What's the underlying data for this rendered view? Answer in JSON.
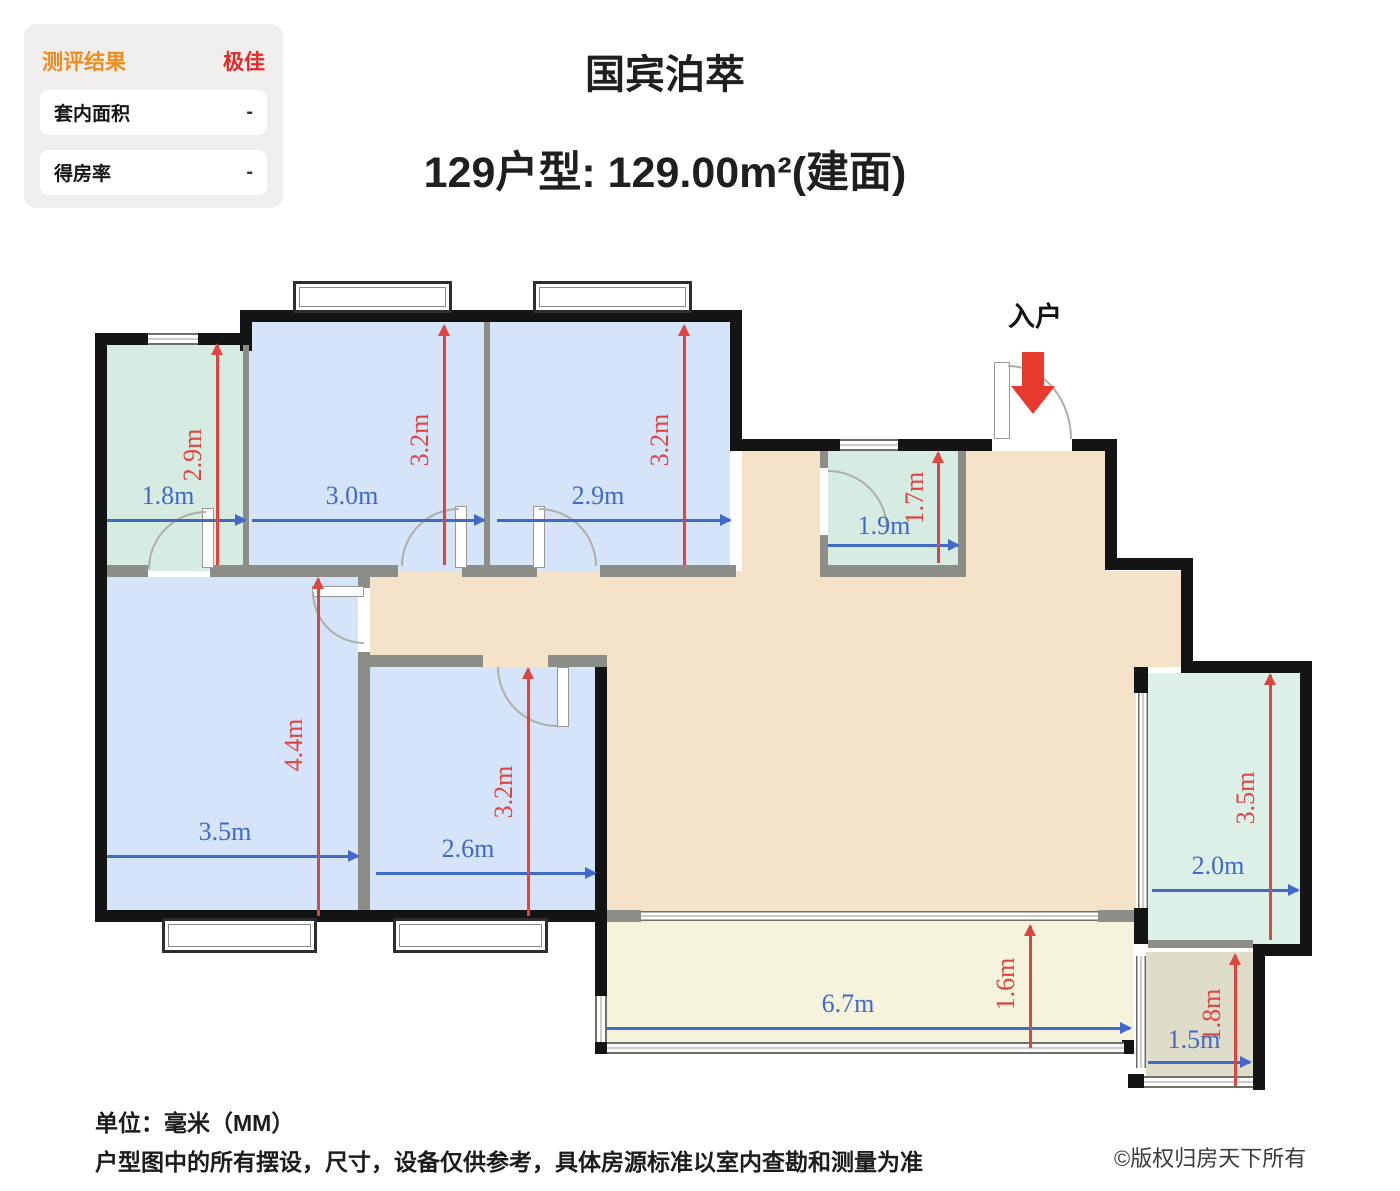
{
  "panel": {
    "title": "测评结果",
    "rating": "极佳",
    "rows": [
      {
        "label": "套内面积",
        "value": "-"
      },
      {
        "label": "得房率",
        "value": "-"
      }
    ]
  },
  "header": {
    "title": "国宾泊萃",
    "subtitle": "129户型: 129.00m²(建面)"
  },
  "plan": {
    "entrance_label": "入户",
    "rooms": [
      {
        "id": "bath-top-left",
        "type": "bathroom",
        "width": "1.8m",
        "height": "2.9m"
      },
      {
        "id": "bedroom-top-1",
        "type": "bedroom",
        "width": "3.0m",
        "height": "3.2m"
      },
      {
        "id": "bedroom-top-2",
        "type": "bedroom",
        "width": "2.9m",
        "height": "3.2m"
      },
      {
        "id": "bathroom-entry",
        "type": "bathroom",
        "width": "1.9m",
        "height": "1.7m"
      },
      {
        "id": "bedroom-master",
        "type": "bedroom",
        "width": "3.5m",
        "height": "4.4m"
      },
      {
        "id": "bedroom-3",
        "type": "bedroom",
        "width": "2.6m",
        "height": "3.2m"
      },
      {
        "id": "room-right",
        "type": "room",
        "width": "2.0m",
        "height": "3.5m"
      },
      {
        "id": "balcony",
        "type": "balcony",
        "width": "6.7m",
        "height": "1.6m"
      },
      {
        "id": "storage-bottom-right",
        "type": "room",
        "width": "1.5m",
        "height": "1.8m"
      }
    ]
  },
  "dims": {
    "bath1_w": "1.8m",
    "bath1_h": "2.9m",
    "bed1_w": "3.0m",
    "bed1_h": "3.2m",
    "bed2_w": "2.9m",
    "bed2_h": "3.2m",
    "bath2_w": "1.9m",
    "bath2_h": "1.7m",
    "master_w": "3.5m",
    "master_h": "4.4m",
    "bed3_w": "2.6m",
    "bed3_h": "3.2m",
    "flex_w": "2.0m",
    "flex_h": "3.5m",
    "balc_w": "6.7m",
    "balc_h": "1.6m",
    "store_w": "1.5m",
    "store_h": "1.8m"
  },
  "footer": {
    "unit": "单位：毫米（MM）",
    "disclaimer": "户型图中的所有摆设，尺寸，设备仅供参考，具体房源标准以室内查勘和测量为准",
    "copyright": "©版权归房天下所有"
  },
  "colors": {
    "wall": "#141414",
    "interior_wall": "#8d8d87",
    "bedroom_fill": "#d5e4f8",
    "bath_fill": "#d6ebe1",
    "flex_fill": "#ddf0e7",
    "living_fill": "#f4e3c9",
    "balcony_fill": "#f5f3dc",
    "storage_fill": "#dfddc9",
    "dim_blue": "#4169c8",
    "dim_red": "#df4540",
    "rating_orange": "#ef8b1f",
    "rating_red": "#e02a2a",
    "entry_arrow": "#e8392f"
  }
}
